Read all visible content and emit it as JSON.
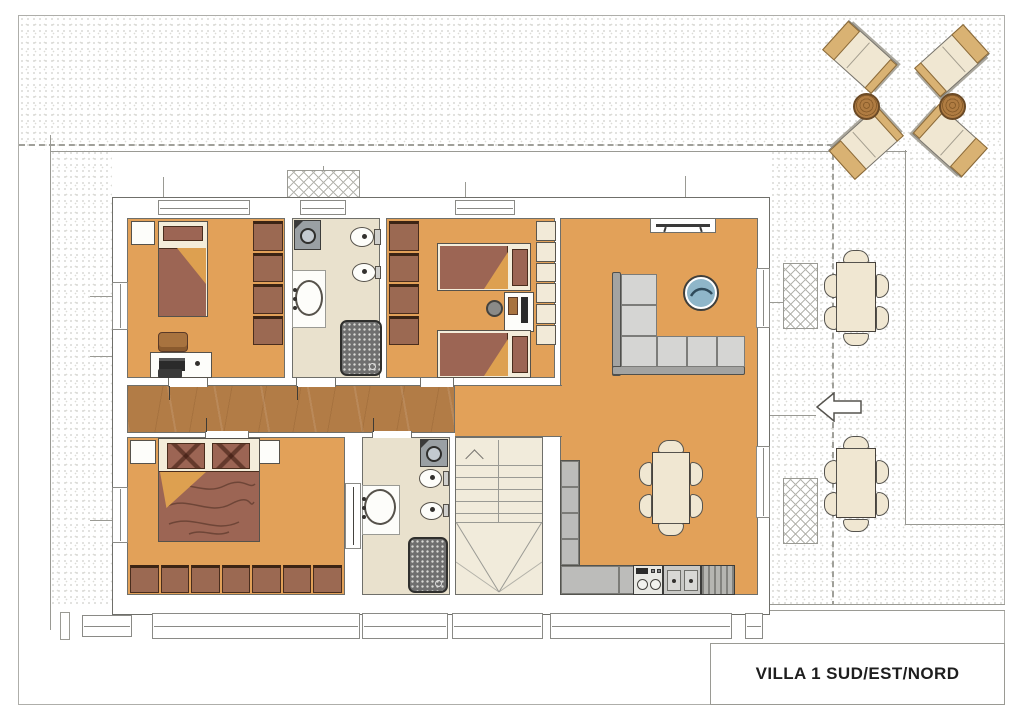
{
  "title_block": {
    "label": "VILLA 1 SUD/EST/NORD"
  },
  "palette": {
    "floor_orange": "#e2a159",
    "floor_wood": "#b27c46",
    "floor_bath": "#e9e1cd",
    "floor_stair": "#f1ebdb",
    "furn_brown": "#9b6952",
    "bed_frame": "#f4edda",
    "blanket_maroon": "#9c6554",
    "fold_tan": "#dda050",
    "sofa_seat": "#d5d5d3",
    "sofa_back": "#a3a3a1",
    "counter_gray": "#bcbcba",
    "appliance_gray": "#9aa0a4",
    "shower_dark": "#6f6f6f",
    "outdoor_cream": "#f0e7d2",
    "outdoor_tan": "#d9b273",
    "table_blue": "#8fb6c9",
    "title_color": "#1e1e1e"
  },
  "plan": {
    "rooms": [
      "bedroom-1",
      "bathroom-1",
      "bedroom-2",
      "living-room",
      "corridor",
      "bedroom-3",
      "bathroom-2",
      "staircase",
      "kitchen-dining"
    ],
    "outdoor": [
      "sun-loungers",
      "patio-dining-tables",
      "planters",
      "entrance-arrow",
      "boundary-dashed-line"
    ]
  }
}
